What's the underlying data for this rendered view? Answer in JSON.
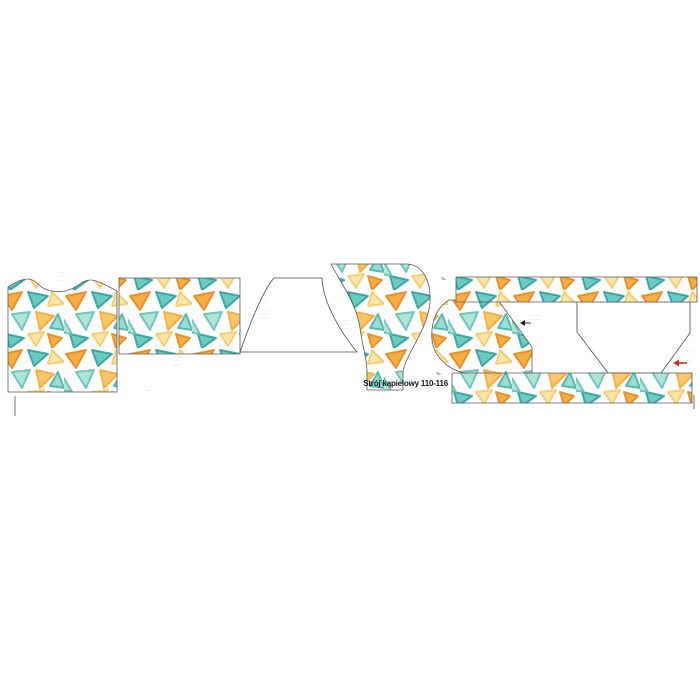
{
  "document": {
    "title": "Strój kąpielowy 110-116",
    "kind": "sewing-pattern-cut-sheet",
    "fabric_marker_left_of_top_strip": "Tk:",
    "fabric_marker_above_title": "Tk:-"
  },
  "fabric": {
    "print_name": "scattered watercolor triangles on white",
    "colors": {
      "background": "#ffffff",
      "teal": "#5EC7BC",
      "teal_dark": "#2D9D99",
      "mint": "#A9E2D6",
      "orange": "#F6A632",
      "orange_light": "#F9C35C",
      "cream_yellow": "#FBE3A0",
      "outline_gray": "#5a5a5a",
      "red_accent": "#D92D2D"
    }
  },
  "pieces": [
    {
      "id": "front-bodice",
      "printed": true,
      "label": "·· ····\n···· ·· ···\n······· · ··"
    },
    {
      "id": "back-panel-rectangle",
      "printed": true,
      "label": "·· ··· ·····\n···· ···\n·······"
    },
    {
      "id": "bottoms-outline-white",
      "printed": false,
      "label": "····· ··\n···\n\n···· ·· ··\n··· ···· ··\n·· ··· ···"
    },
    {
      "id": "bottoms-front-printed",
      "printed": true,
      "label": "···· ··\n··· ·· ····\n······ · ···"
    },
    {
      "id": "side-panel-printed",
      "printed": true,
      "annotation": "·· ······ ···\n·· ·······\n·····"
    },
    {
      "id": "trapezoid-outline-white",
      "printed": false,
      "annotation": "······ ···\n····\n·· ··\n··· ···\n···· ··"
    },
    {
      "id": "waistband-strip-top",
      "printed": true,
      "label": ""
    },
    {
      "id": "waistband-strip-bottom",
      "printed": true,
      "label": ""
    }
  ],
  "small_marks": {
    "under-back-panel": "⌐··",
    "left_crop_mark": "|",
    "right_crop_mark": "|"
  }
}
